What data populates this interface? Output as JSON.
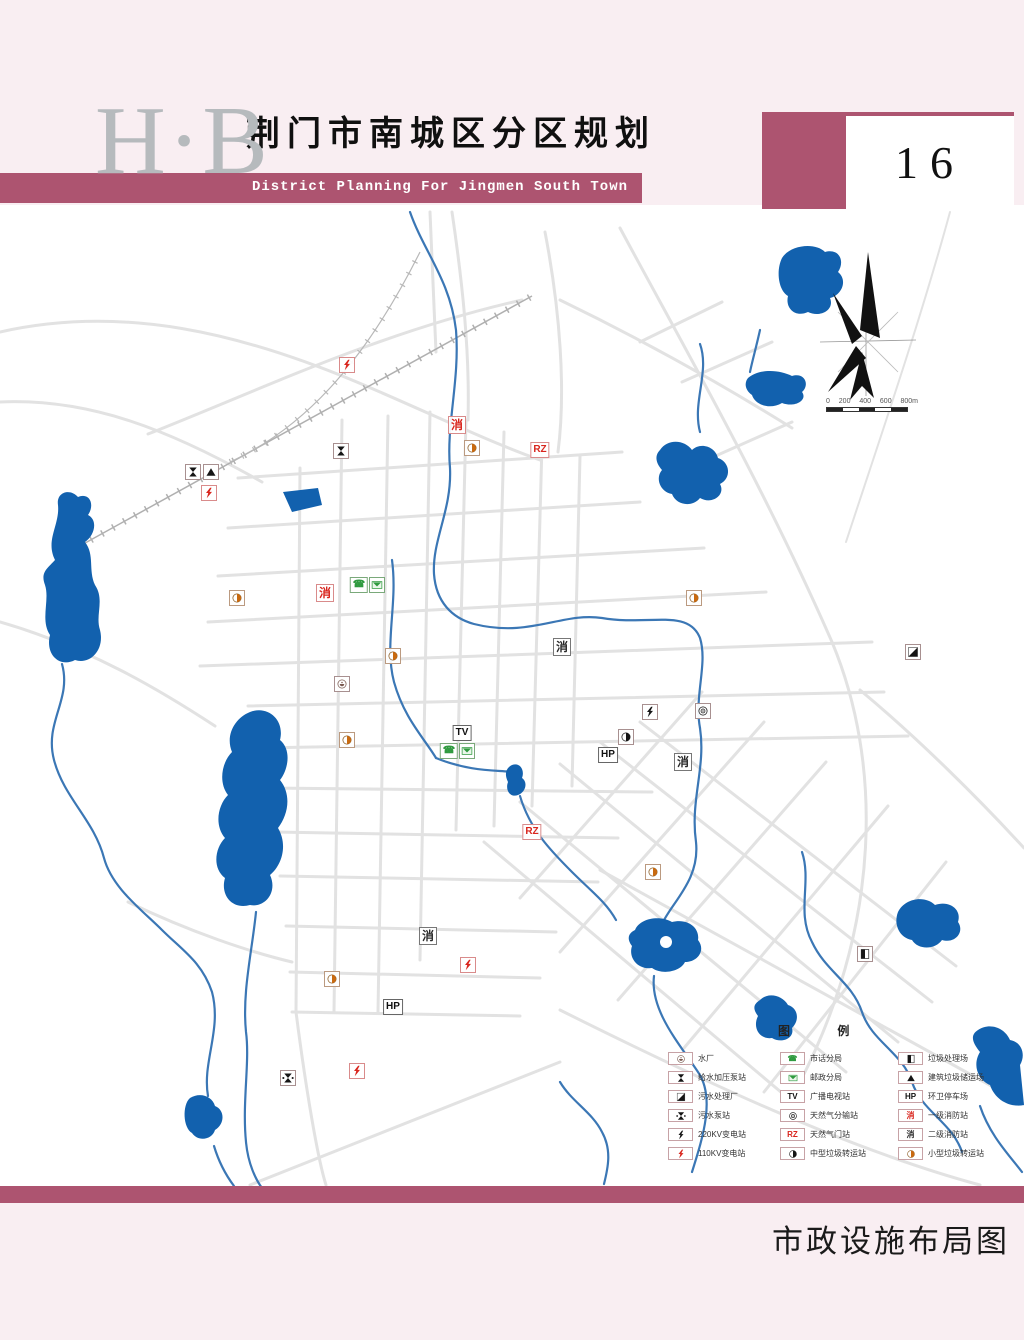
{
  "page": {
    "background": "#f9eef2",
    "accent": "#ad5470"
  },
  "header": {
    "logo": "H·B",
    "title_cn": "荆门市南城区分区规划",
    "title_en": "District Planning For Jingmen South Town",
    "page_number": "16"
  },
  "footer": {
    "caption": "市政设施布局图"
  },
  "colors": {
    "lake": "#1261ae",
    "river": "#3b77b5",
    "road": "#e2e2e2",
    "orange": "#c96a10",
    "green": "#2f9a3f",
    "red": "#d9251d",
    "black": "#151515"
  },
  "icon_glyphs": {
    "fire-1": {
      "glyph": "消",
      "color": "#d9251d"
    },
    "fire-2": {
      "glyph": "消",
      "color": "#2a2a2a"
    },
    "gas-gate": {
      "glyph": "RZ",
      "color": "#d9251d"
    },
    "tv": {
      "glyph": "TV",
      "color": "#111111"
    },
    "hp": {
      "glyph": "HP",
      "color": "#111111"
    },
    "phone": {
      "glyph": "☎",
      "color": "#2f9a3f"
    }
  },
  "map": {
    "compass": "north-arrow",
    "scale_bar": {
      "labels": [
        "0",
        "200",
        "400",
        "600",
        "800m"
      ]
    },
    "markers": [
      {
        "type": "substation-110",
        "x": 347,
        "y": 365
      },
      {
        "type": "fire-1",
        "x": 457,
        "y": 425
      },
      {
        "type": "garbage-small",
        "x": 472,
        "y": 448
      },
      {
        "type": "gas-gate",
        "x": 540,
        "y": 450
      },
      {
        "type": "pump-water",
        "x": 341,
        "y": 451
      },
      {
        "type": "pump-water",
        "x": 193,
        "y": 472
      },
      {
        "type": "construction-waste",
        "x": 211,
        "y": 472
      },
      {
        "type": "substation-110",
        "x": 209,
        "y": 493
      },
      {
        "type": "phone",
        "x": 359,
        "y": 585
      },
      {
        "type": "mail",
        "x": 377,
        "y": 585
      },
      {
        "type": "fire-1",
        "x": 325,
        "y": 593
      },
      {
        "type": "garbage-small",
        "x": 237,
        "y": 598
      },
      {
        "type": "garbage-small",
        "x": 694,
        "y": 598
      },
      {
        "type": "fire-2",
        "x": 562,
        "y": 647
      },
      {
        "type": "garbage-small",
        "x": 393,
        "y": 656
      },
      {
        "type": "sewage-plant",
        "x": 913,
        "y": 652
      },
      {
        "type": "water-plant",
        "x": 342,
        "y": 684
      },
      {
        "type": "substation-220",
        "x": 650,
        "y": 712
      },
      {
        "type": "gas-dist",
        "x": 703,
        "y": 711
      },
      {
        "type": "tv",
        "x": 462,
        "y": 733
      },
      {
        "type": "garbage-mid",
        "x": 626,
        "y": 737
      },
      {
        "type": "garbage-small",
        "x": 347,
        "y": 740
      },
      {
        "type": "phone",
        "x": 449,
        "y": 751
      },
      {
        "type": "mail",
        "x": 467,
        "y": 751
      },
      {
        "type": "hp",
        "x": 608,
        "y": 755
      },
      {
        "type": "fire-2",
        "x": 683,
        "y": 762
      },
      {
        "type": "gas-gate",
        "x": 532,
        "y": 832
      },
      {
        "type": "garbage-small",
        "x": 653,
        "y": 872
      },
      {
        "type": "fire-2",
        "x": 428,
        "y": 936
      },
      {
        "type": "garbage-site",
        "x": 865,
        "y": 954
      },
      {
        "type": "substation-110",
        "x": 468,
        "y": 965
      },
      {
        "type": "garbage-small",
        "x": 332,
        "y": 979
      },
      {
        "type": "hp",
        "x": 393,
        "y": 1007
      },
      {
        "type": "substation-110",
        "x": 357,
        "y": 1071
      },
      {
        "type": "pump-sewage",
        "x": 288,
        "y": 1078
      }
    ]
  },
  "legend": {
    "title": "图 例",
    "columns": [
      [
        {
          "icon": "water-plant",
          "label": "水厂"
        },
        {
          "icon": "pump-water",
          "label": "给水加压泵站"
        },
        {
          "icon": "sewage-plant",
          "label": "污水处理厂"
        },
        {
          "icon": "pump-sewage",
          "label": "污水泵站"
        },
        {
          "icon": "substation-220",
          "label": "220KV变电站"
        },
        {
          "icon": "substation-110",
          "label": "110KV变电站"
        }
      ],
      [
        {
          "icon": "phone",
          "label": "市话分局"
        },
        {
          "icon": "mail",
          "label": "邮政分局"
        },
        {
          "icon": "tv",
          "label": "广播电视站"
        },
        {
          "icon": "gas-dist",
          "label": "天然气分输站"
        },
        {
          "icon": "gas-gate",
          "label": "天然气门站"
        },
        {
          "icon": "garbage-mid",
          "label": "中型垃圾转运站"
        }
      ],
      [
        {
          "icon": "garbage-site",
          "label": "垃圾处理场"
        },
        {
          "icon": "construction-waste",
          "label": "建筑垃圾储运场"
        },
        {
          "icon": "hp",
          "label": "环卫停车场"
        },
        {
          "icon": "fire-1",
          "label": "一级消防站"
        },
        {
          "icon": "fire-2",
          "label": "二级消防站"
        },
        {
          "icon": "garbage-small",
          "label": "小型垃圾转运站"
        }
      ]
    ]
  }
}
